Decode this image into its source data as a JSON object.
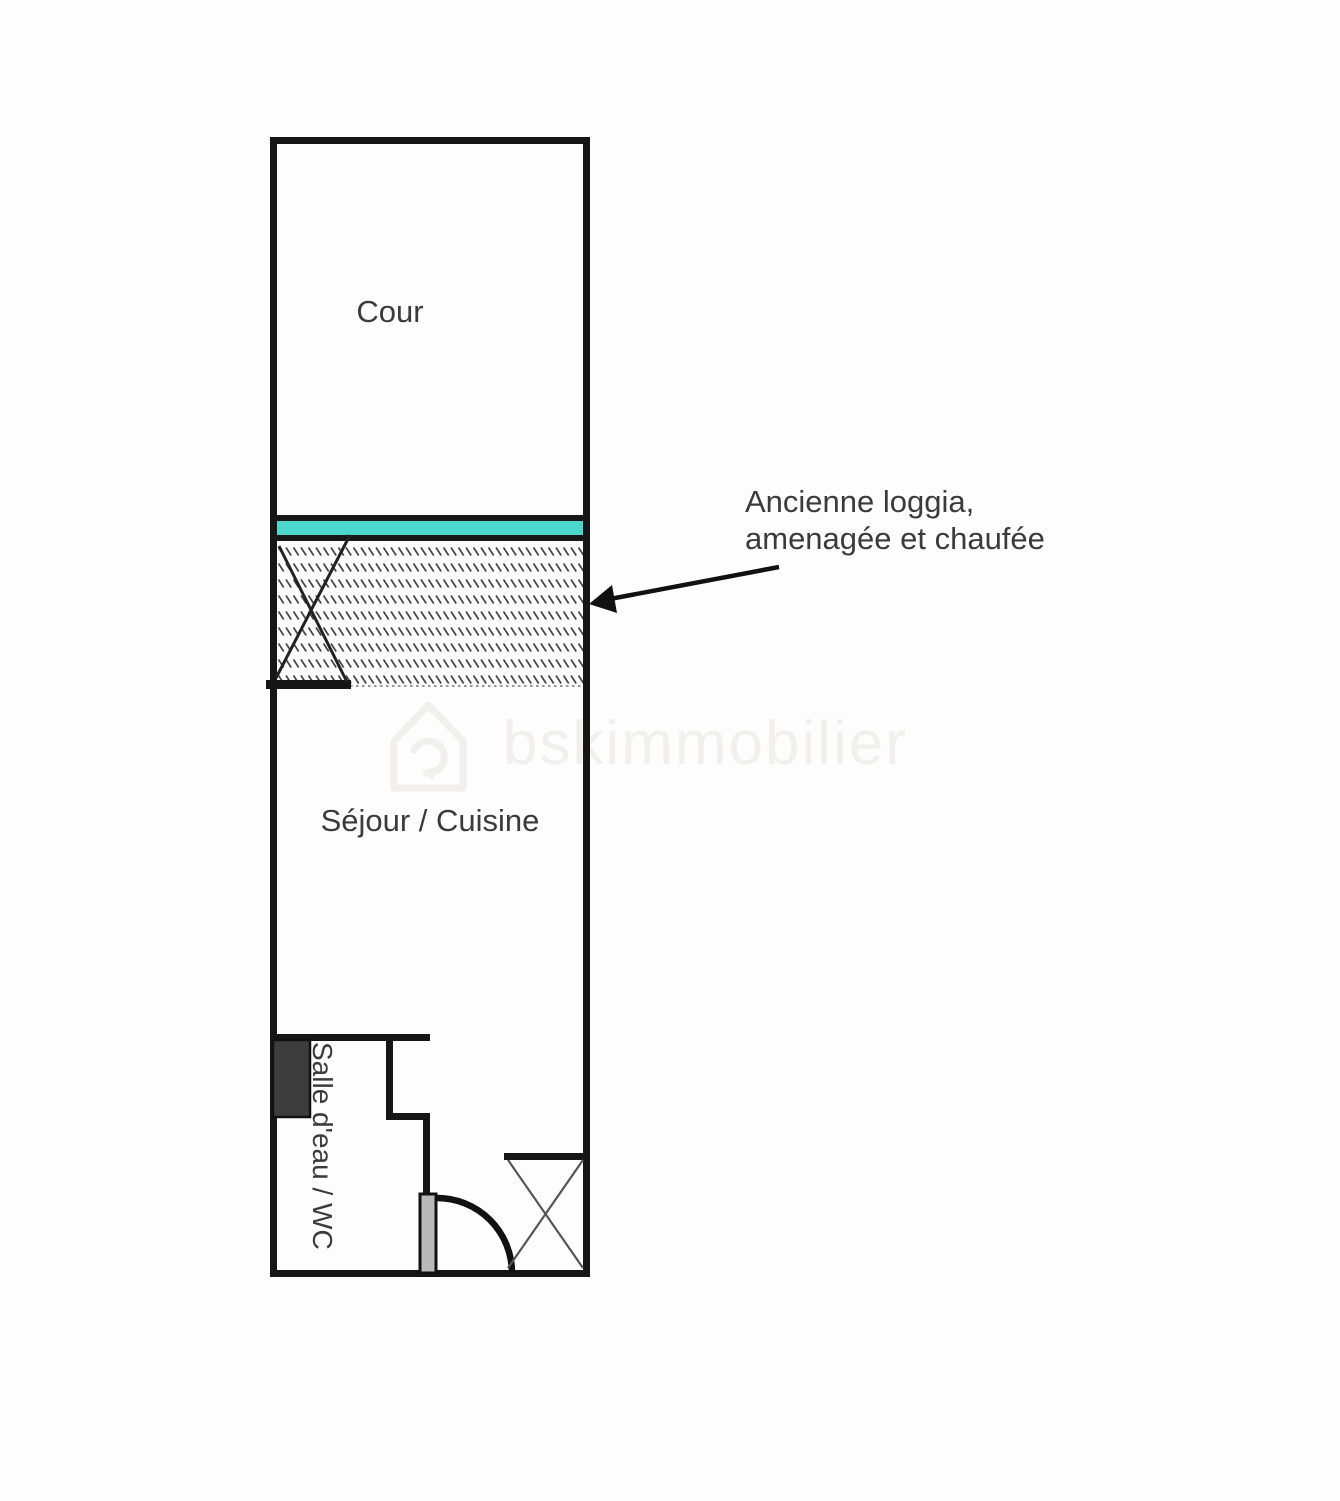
{
  "canvas": {
    "width": 1340,
    "height": 1501,
    "background": "#fdfdfd"
  },
  "colors": {
    "bg": "#fdfdfd",
    "wall": "#161616",
    "glazing": "#4bd7ce",
    "hatch": "#454545",
    "door_leaf": "#b9b9b9",
    "fixture": "#3d3d3d",
    "watermark": "#f1f0ee",
    "label": "#3b3b3b"
  },
  "labels": {
    "cour": "Cour",
    "sejour": "Séjour / Cuisine",
    "salle_eau": "Salle d'eau / WC"
  },
  "annotation": {
    "line1": "Ancienne loggia,",
    "line2": "amenagée et chaufée"
  },
  "watermark": {
    "text": "bskimmobilier"
  }
}
